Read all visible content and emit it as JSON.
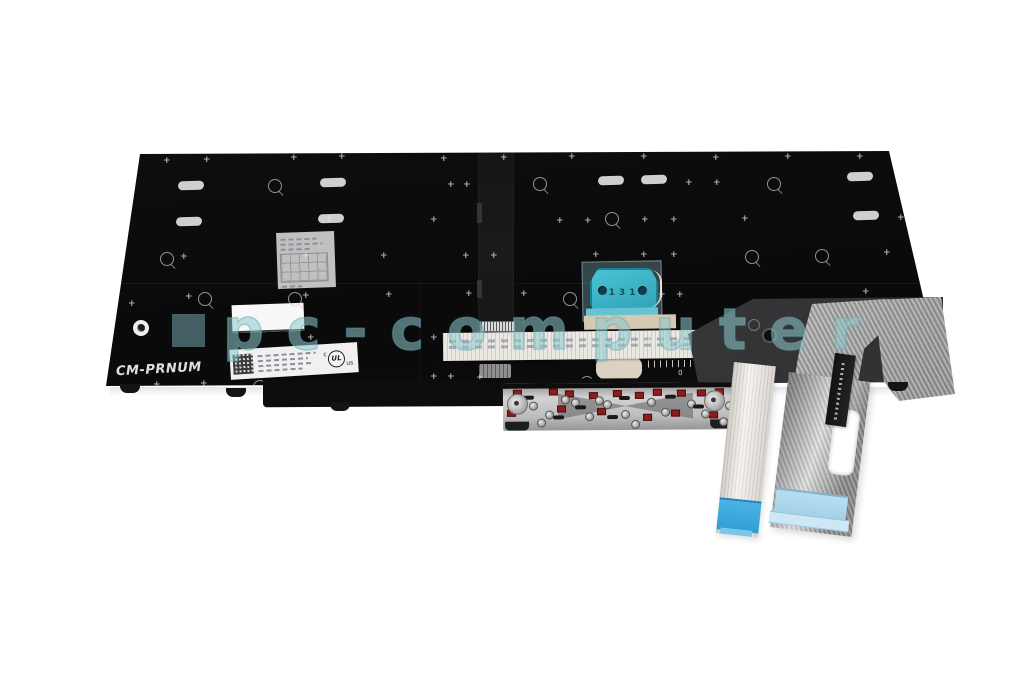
{
  "canvas": {
    "width": 1024,
    "height": 680,
    "background": "#ffffff"
  },
  "watermark": {
    "text": "pc-computer",
    "color": "#8fcbd1"
  },
  "panel": {
    "marking": "CM-PRNUM",
    "color": "#0c0c0d"
  },
  "trackpoint": {
    "marking": "131",
    "pod_color": "#3ab0c6",
    "film_color": "#9fd4da"
  },
  "certification": {
    "c": "c",
    "ul": "UL",
    "us": "us"
  },
  "ruler": {
    "marks": [
      {
        "label": "0",
        "x": 30
      },
      {
        "label": "1",
        "x": 58
      },
      {
        "label": "4",
        "x": 110
      },
      {
        "label": "8",
        "x": 225
      }
    ]
  },
  "cables": {
    "backlight_end_color": "#3fb0e2",
    "main_end_color": "#a9d6ea",
    "key_pad_color": "#8c1d1d"
  },
  "decor": {
    "ovals": [
      [
        178,
        181
      ],
      [
        320,
        178
      ],
      [
        598,
        176
      ],
      [
        641,
        175
      ],
      [
        847,
        172
      ],
      [
        176,
        217
      ],
      [
        318,
        214
      ],
      [
        853,
        211
      ]
    ],
    "plus_marks": [
      [
        163,
        157
      ],
      [
        203,
        156
      ],
      [
        290,
        154
      ],
      [
        338,
        153
      ],
      [
        440,
        155
      ],
      [
        500,
        154
      ],
      [
        568,
        153
      ],
      [
        640,
        153
      ],
      [
        712,
        154
      ],
      [
        784,
        153
      ],
      [
        856,
        153
      ],
      [
        447,
        181
      ],
      [
        463,
        181
      ],
      [
        685,
        179
      ],
      [
        713,
        179
      ],
      [
        325,
        215
      ],
      [
        430,
        216
      ],
      [
        556,
        217
      ],
      [
        584,
        217
      ],
      [
        641,
        216
      ],
      [
        670,
        216
      ],
      [
        741,
        215
      ],
      [
        897,
        214
      ],
      [
        180,
        253
      ],
      [
        302,
        252
      ],
      [
        380,
        252
      ],
      [
        462,
        252
      ],
      [
        490,
        252
      ],
      [
        592,
        251
      ],
      [
        640,
        251
      ],
      [
        670,
        251
      ],
      [
        883,
        249
      ],
      [
        128,
        300
      ],
      [
        185,
        293
      ],
      [
        302,
        292
      ],
      [
        385,
        291
      ],
      [
        465,
        290
      ],
      [
        520,
        290
      ],
      [
        658,
        291
      ],
      [
        676,
        291
      ],
      [
        862,
        288
      ],
      [
        307,
        334
      ],
      [
        430,
        334
      ],
      [
        645,
        337
      ],
      [
        153,
        381
      ],
      [
        200,
        380
      ],
      [
        430,
        373
      ],
      [
        447,
        373
      ],
      [
        476,
        374
      ],
      [
        885,
        370
      ],
      [
        920,
        367
      ]
    ],
    "circle_marks": [
      [
        268,
        179
      ],
      [
        533,
        177
      ],
      [
        767,
        177
      ],
      [
        605,
        212
      ],
      [
        160,
        252
      ],
      [
        745,
        250
      ],
      [
        815,
        249
      ],
      [
        198,
        292
      ],
      [
        288,
        292
      ],
      [
        563,
        292
      ],
      [
        253,
        380
      ],
      [
        580,
        376
      ]
    ],
    "feet": [
      [
        120,
        384
      ],
      [
        226,
        388
      ],
      [
        330,
        402
      ],
      [
        888,
        382
      ]
    ]
  },
  "mech": {
    "red_pads": [
      [
        10,
        6
      ],
      [
        46,
        5
      ],
      [
        62,
        7
      ],
      [
        86,
        9
      ],
      [
        110,
        7
      ],
      [
        132,
        9
      ],
      [
        150,
        6
      ],
      [
        174,
        7
      ],
      [
        194,
        7
      ],
      [
        212,
        6
      ],
      [
        4,
        26
      ],
      [
        54,
        22
      ],
      [
        94,
        25
      ],
      [
        140,
        31
      ],
      [
        168,
        27
      ],
      [
        206,
        29
      ],
      [
        228,
        10
      ]
    ],
    "screws": [
      [
        26,
        18
      ],
      [
        42,
        27
      ],
      [
        68,
        15
      ],
      [
        82,
        29
      ],
      [
        100,
        17
      ],
      [
        118,
        27
      ],
      [
        144,
        15
      ],
      [
        158,
        25
      ],
      [
        184,
        17
      ],
      [
        198,
        27
      ],
      [
        222,
        19
      ],
      [
        34,
        35
      ],
      [
        128,
        37
      ],
      [
        216,
        35
      ],
      [
        58,
        12
      ],
      [
        92,
        13
      ]
    ],
    "slots": [
      [
        20,
        12
      ],
      [
        72,
        22
      ],
      [
        116,
        13
      ],
      [
        162,
        12
      ],
      [
        190,
        22
      ],
      [
        232,
        24
      ],
      [
        50,
        32
      ],
      [
        104,
        32
      ]
    ],
    "cams": [
      [
        4,
        10
      ],
      [
        201,
        8
      ]
    ]
  }
}
